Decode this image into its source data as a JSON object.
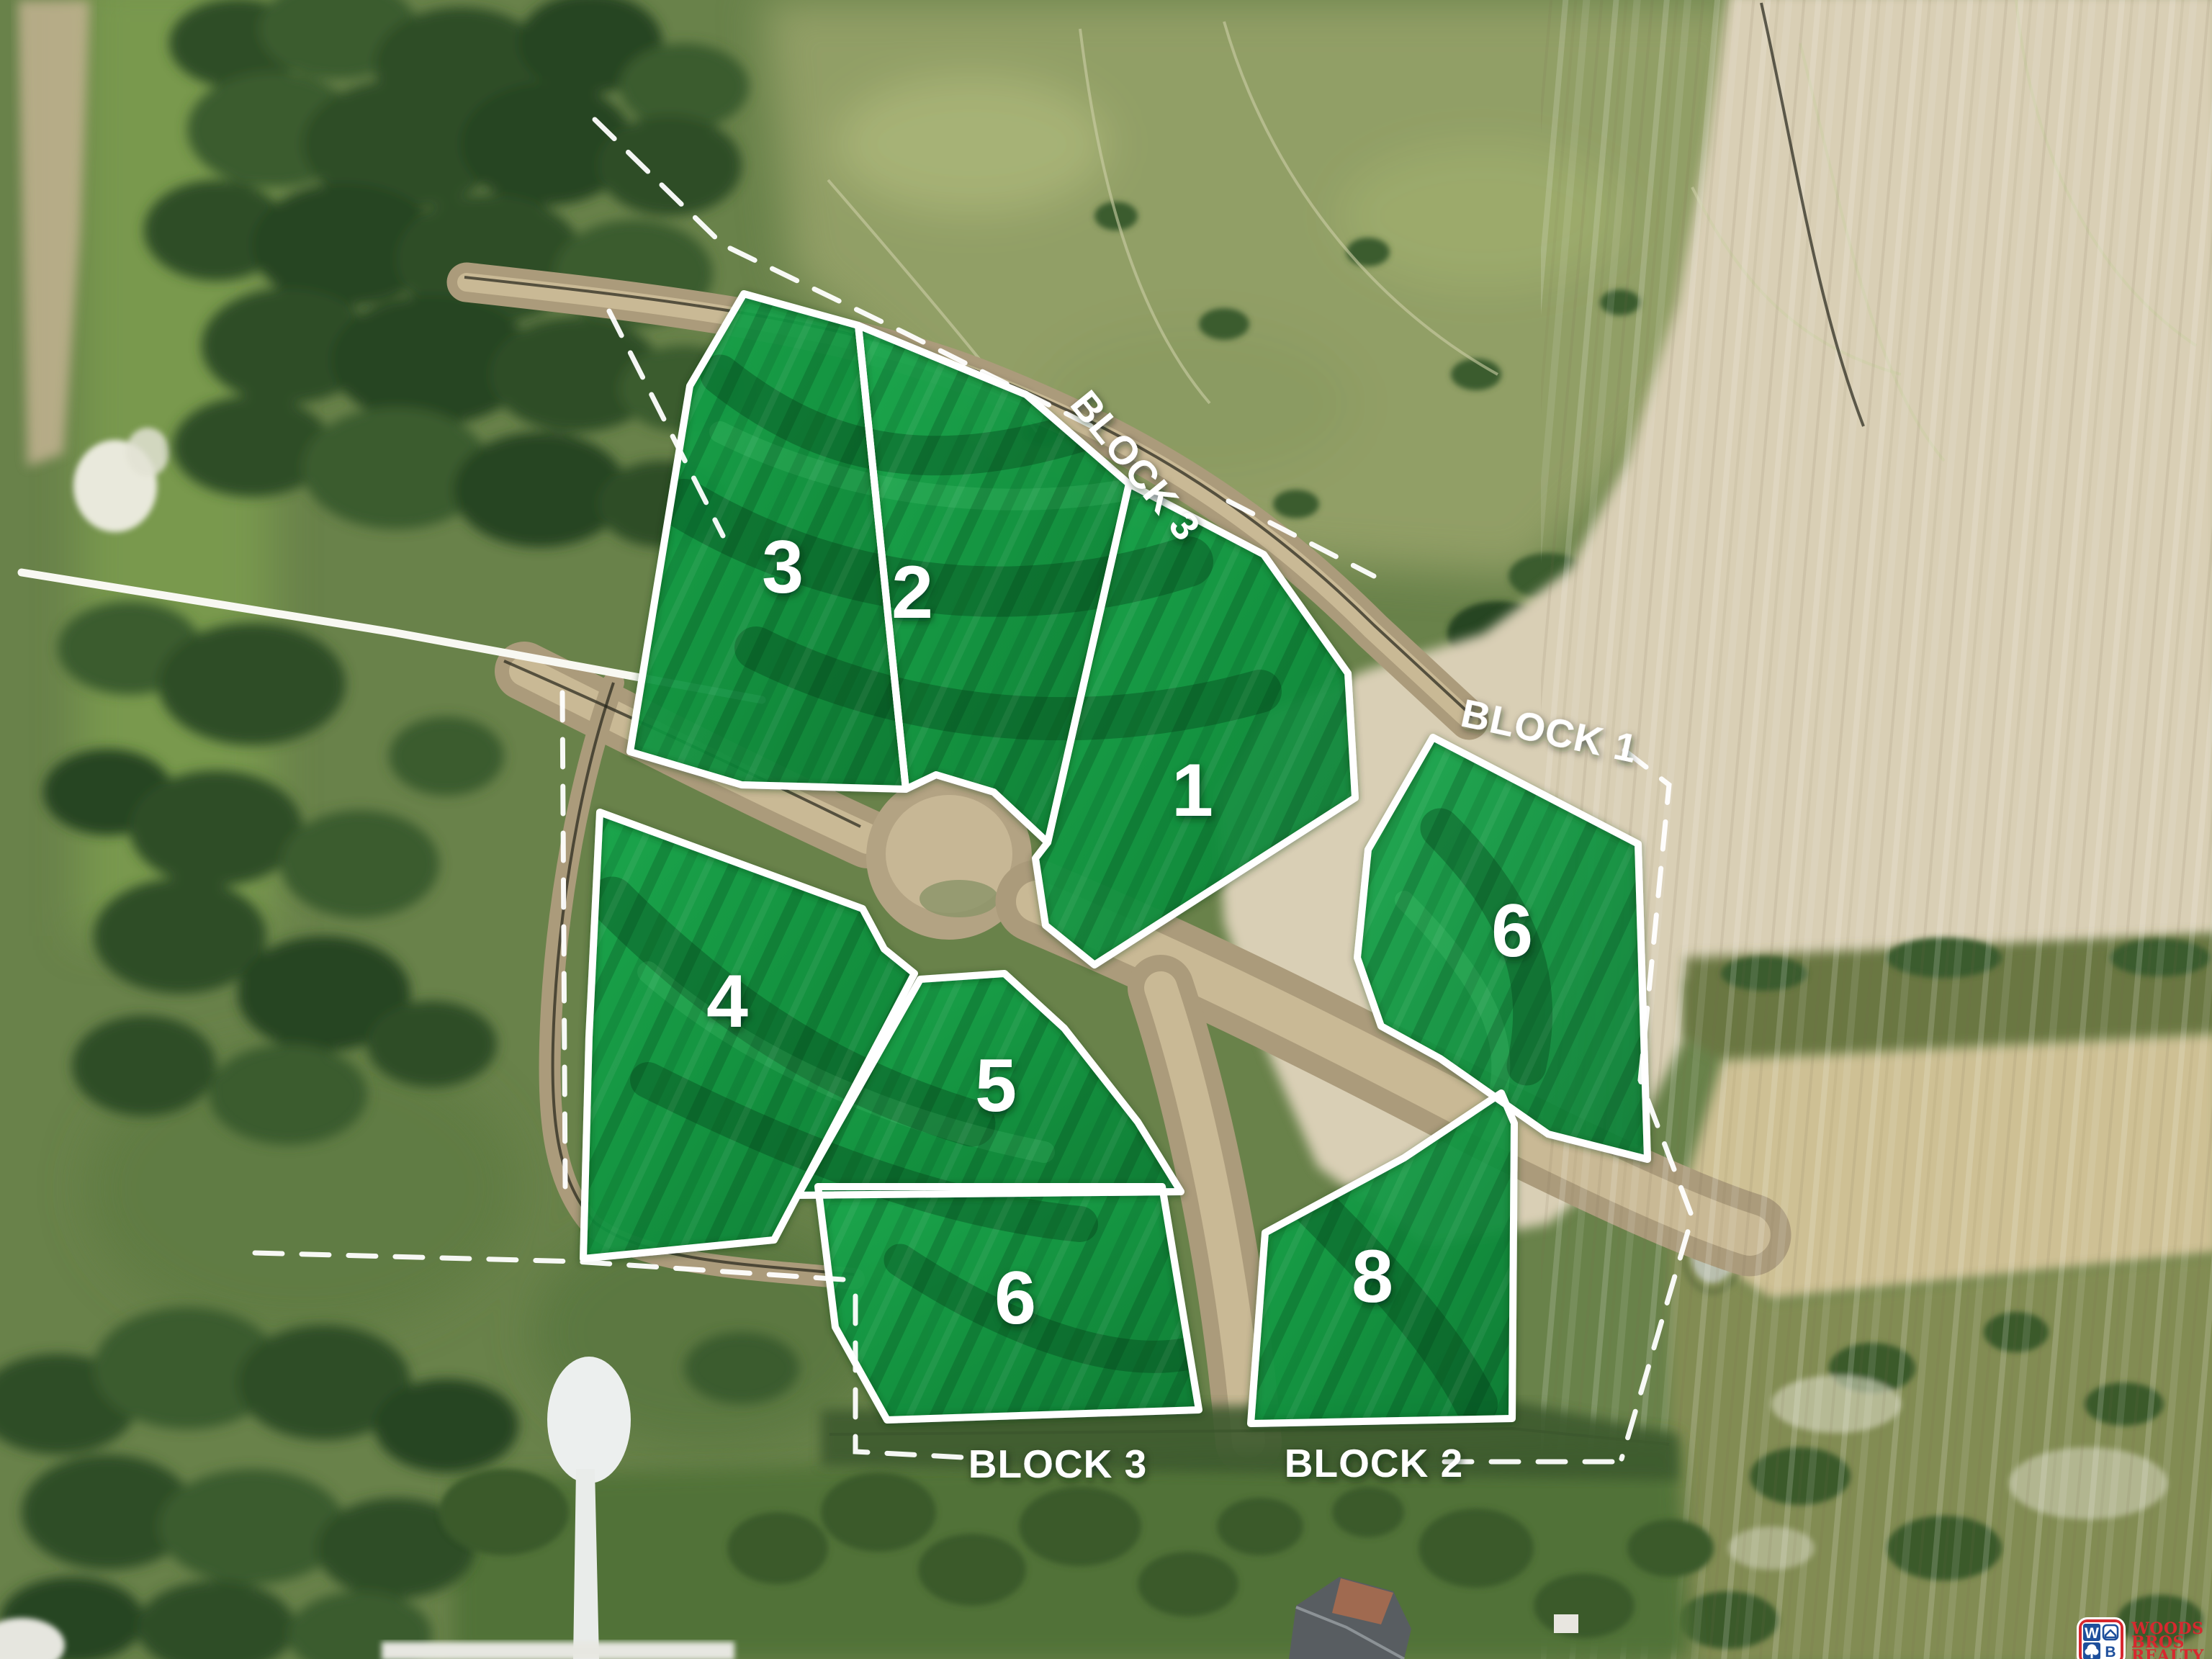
{
  "plat": {
    "block_labels": [
      {
        "id": "block-3-top",
        "text": "BLOCK 3"
      },
      {
        "id": "block-1",
        "text": "BLOCK 1"
      },
      {
        "id": "block-3-bottom",
        "text": "BLOCK 3"
      },
      {
        "id": "block-2",
        "text": "BLOCK 2"
      }
    ],
    "lots": [
      {
        "number": "3",
        "block": "BLOCK 3"
      },
      {
        "number": "2",
        "block": "BLOCK 3"
      },
      {
        "number": "1",
        "block": "BLOCK 3"
      },
      {
        "number": "4",
        "block": "BLOCK 3"
      },
      {
        "number": "5",
        "block": "BLOCK 3"
      },
      {
        "number": "6",
        "block": "BLOCK 1"
      },
      {
        "number": "6",
        "block": "BLOCK 3"
      },
      {
        "number": "8",
        "block": "BLOCK 2"
      }
    ],
    "colors": {
      "lot_overlay_green": "#12a047",
      "lot_border_white": "#ffffff",
      "label_text": "#ffffff",
      "dirt_tan": "#d9cfb5"
    }
  },
  "logo": {
    "brand_lines": [
      "WOODS",
      "BROS",
      "REALTY"
    ],
    "monogram": {
      "top_left": "W",
      "bottom_right": "B"
    },
    "colors": {
      "red": "#d7282f",
      "blue": "#1e4f9c",
      "white": "#ffffff"
    }
  }
}
